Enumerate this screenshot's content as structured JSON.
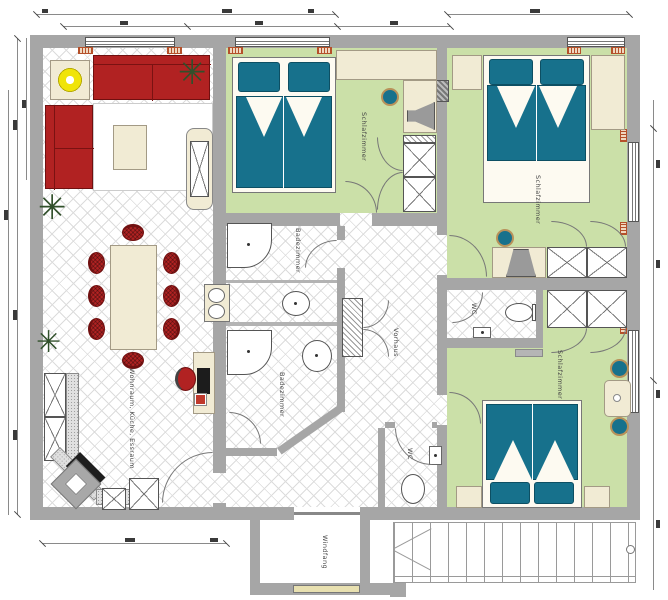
{
  "plan": {
    "title": "Grundriss Wohnung",
    "colors": {
      "wall": "#a6a6a6",
      "green": "#cbe0a8",
      "teal": "#17718c",
      "red": "#b12222",
      "beige": "#f1ebd4",
      "tileline": "#dcdcdc",
      "plant": "#31502b",
      "yellow": "#f0e40a"
    },
    "icons": {
      "plant": "✳"
    },
    "rooms": [
      {
        "id": "living",
        "label": "Wohnraum, Küche, Essraum"
      },
      {
        "id": "bedroom1",
        "label": "Schlafzimmer"
      },
      {
        "id": "bedroom2",
        "label": "Schlafzimmer"
      },
      {
        "id": "bedroom3",
        "label": "Schlafzimmer"
      },
      {
        "id": "bath1",
        "label": "Badezimmer"
      },
      {
        "id": "bath2",
        "label": "Badezimmer"
      },
      {
        "id": "wc1",
        "label": "WC"
      },
      {
        "id": "wc2",
        "label": "WC"
      },
      {
        "id": "hall",
        "label": "Vorhaus"
      },
      {
        "id": "vestibule",
        "label": "Windfang"
      }
    ]
  }
}
